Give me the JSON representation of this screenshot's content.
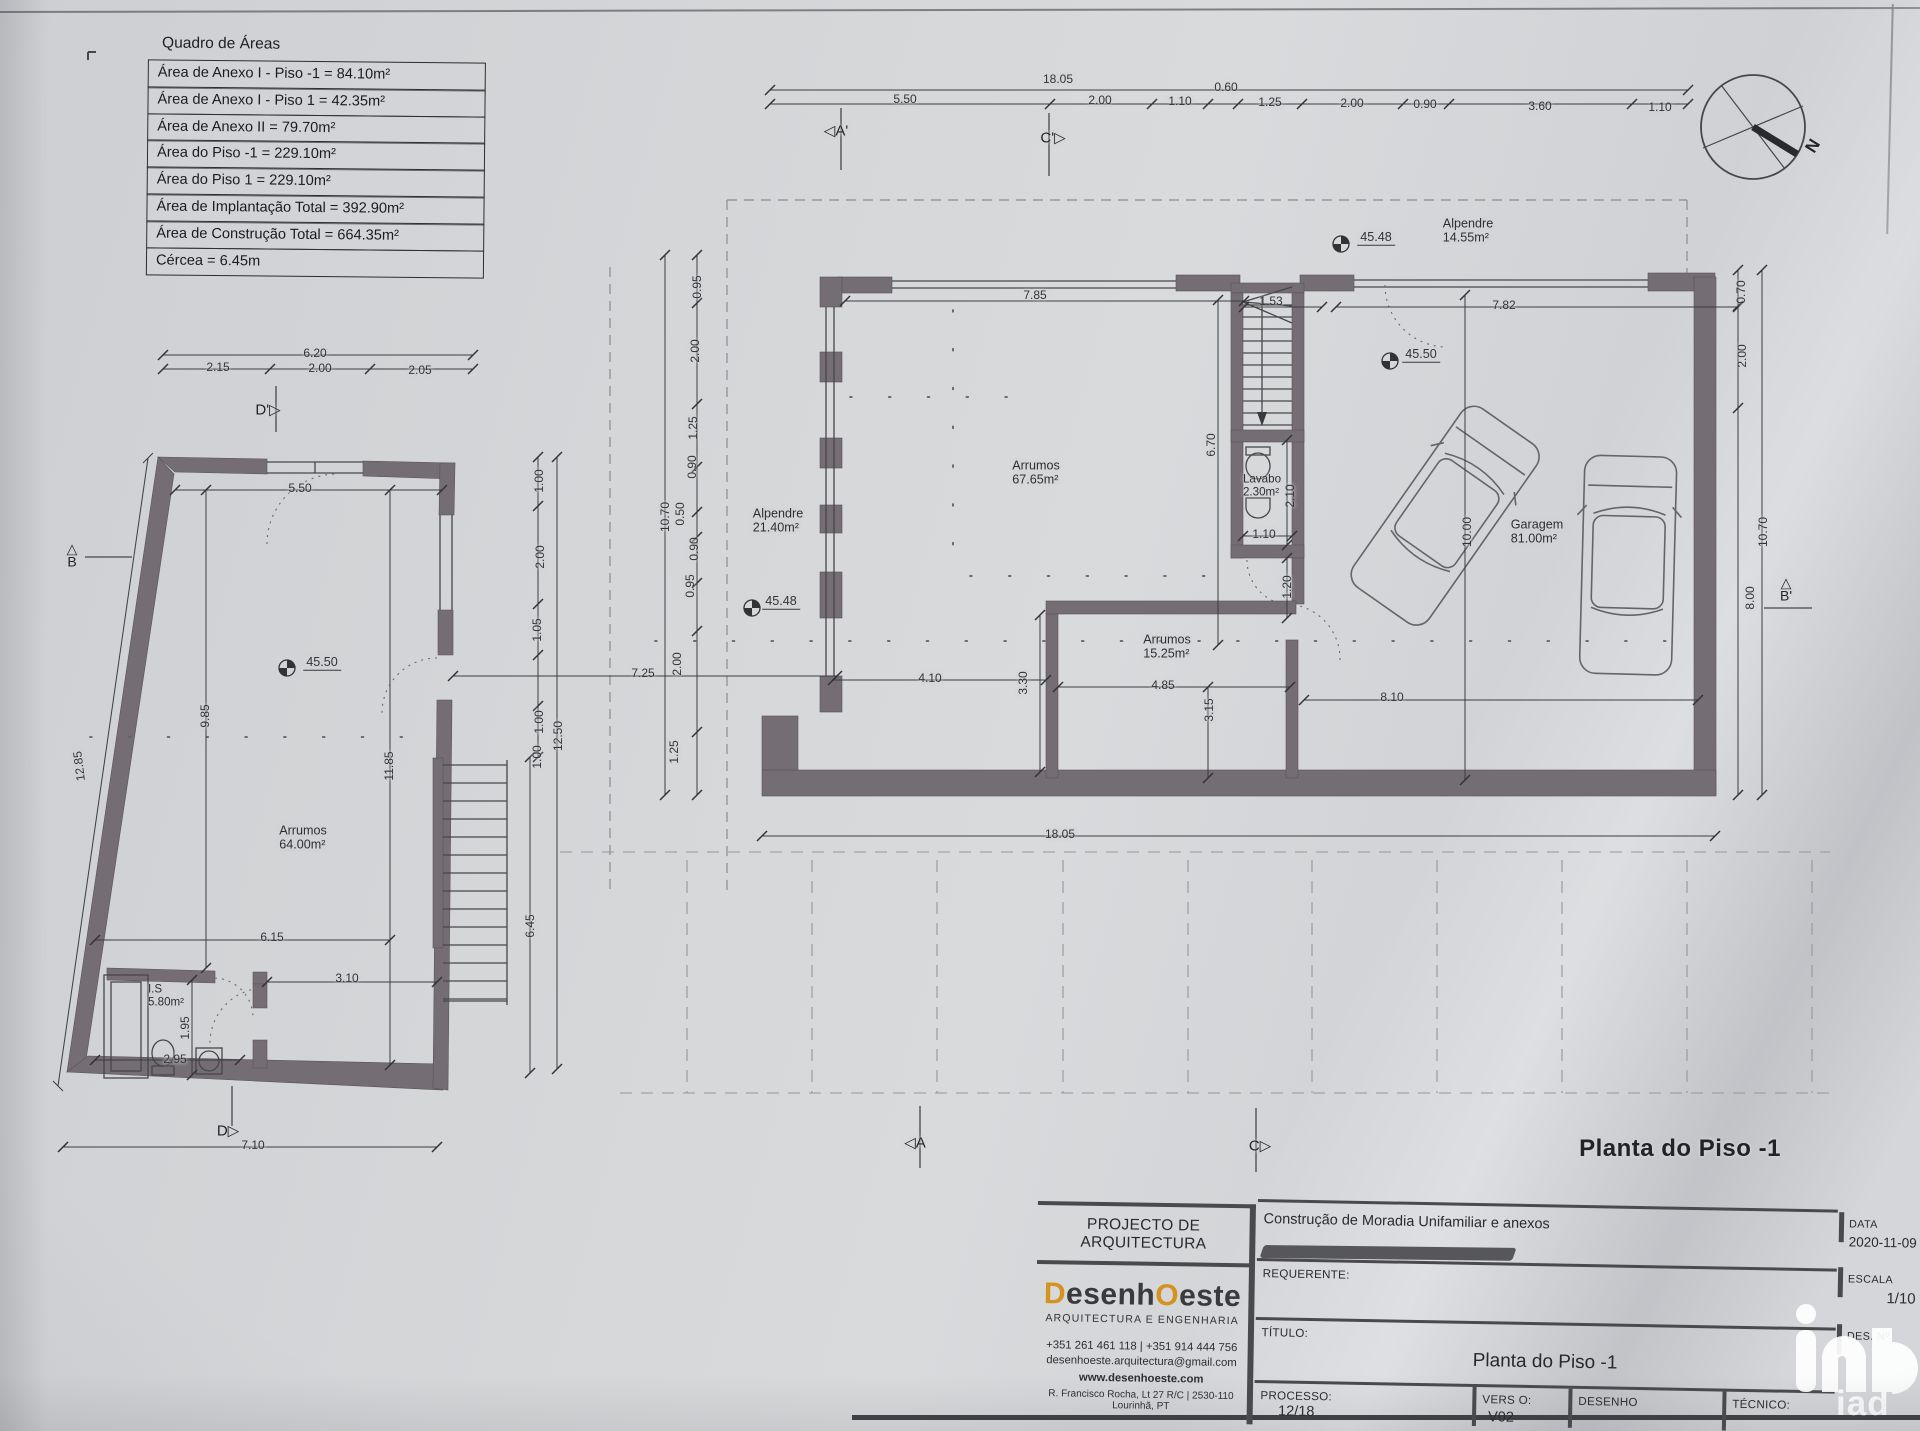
{
  "area_table": {
    "title": "Quadro de Áreas",
    "rows": [
      "Área de Anexo I - Piso -1 = 84.10m²",
      "Área de Anexo I - Piso 1 = 42.35m²",
      "Área de Anexo II = 79.70m²",
      "Área do Piso -1 = 229.10m²",
      "Área do Piso 1 = 229.10m²",
      "Área de Implantação Total = 392.90m²",
      "Área de Construção Total = 664.35m²",
      "Cércea = 6.45m"
    ]
  },
  "title_block": {
    "header": "PROJECTO DE ARQUITECTURA",
    "logo": {
      "d": "D",
      "mid": "esenh",
      "o": "O",
      "end": "este"
    },
    "tagline": "ARQUITECTURA E ENGENHARIA",
    "phone": "+351 261 461 118  |  +351 914 444 756",
    "email": "desenhoeste.arquitectura@gmail.com",
    "website": "www.desenhoeste.com",
    "address": "R. Francisco Rocha, Lt 27 R/C  |  2530-110 Lourinhã, PT",
    "project": "Construção de Moradia Unifamiliar e anexos",
    "requerente_label": "REQUERENTE:",
    "titulo_label": "TÍTULO:",
    "titulo_value": "Planta do Piso -1",
    "processo_label": "PROCESSO:",
    "processo_value": "12/18",
    "versao_label": "VERS O:",
    "versao_value": "V02",
    "desenho_label": "DESENHO",
    "tecnico_label": "TÉCNICO:",
    "data_label": "DATA",
    "data_value": "2020-11-09",
    "escala_label": "ESCALA",
    "escala_value": "1/10",
    "desno_label": "DES. Nº",
    "watermark": "iad"
  },
  "labels": [
    {
      "t": "18.05",
      "x": 1058,
      "y": 80
    },
    {
      "t": "5.50",
      "x": 905,
      "y": 100
    },
    {
      "t": "2.00",
      "x": 1100,
      "y": 101
    },
    {
      "t": "1.10",
      "x": 1180,
      "y": 102
    },
    {
      "t": "0.60",
      "x": 1226,
      "y": 88
    },
    {
      "t": "1.25",
      "x": 1270,
      "y": 103
    },
    {
      "t": "2.00",
      "x": 1352,
      "y": 104
    },
    {
      "t": "0.90",
      "x": 1425,
      "y": 105
    },
    {
      "t": "3.60",
      "x": 1540,
      "y": 107
    },
    {
      "t": "1.10",
      "x": 1660,
      "y": 108
    },
    {
      "t": "◁A'",
      "x": 836,
      "y": 131,
      "c": "mk",
      "n": "section-marker-a-prime"
    },
    {
      "t": "C'▷",
      "x": 1053,
      "y": 138,
      "c": "mk",
      "n": "section-marker-c-prime"
    },
    {
      "t": "6.20",
      "x": 315,
      "y": 354
    },
    {
      "t": "2.15",
      "x": 218,
      "y": 368
    },
    {
      "t": "2.00",
      "x": 320,
      "y": 369
    },
    {
      "t": "2.05",
      "x": 420,
      "y": 371
    },
    {
      "t": "D'▷",
      "x": 268,
      "y": 410,
      "c": "mk",
      "n": "section-marker-d-prime"
    },
    {
      "t": "5.50",
      "x": 300,
      "y": 489
    },
    {
      "t": "45.50",
      "x": 322,
      "y": 663,
      "c": "lv",
      "n": "level-45-50-annex"
    },
    {
      "t": "Arrumos\n64.00m²",
      "x": 303,
      "y": 838,
      "c": "rm",
      "n": "room-label-arrumos-annex"
    },
    {
      "t": "9.85",
      "x": 206,
      "y": 716,
      "r": -90
    },
    {
      "t": "12.85",
      "x": 80,
      "y": 766,
      "r": -97
    },
    {
      "t": "11.85",
      "x": 390,
      "y": 766,
      "r": -90
    },
    {
      "t": "6.15",
      "x": 272,
      "y": 938
    },
    {
      "t": "3.10",
      "x": 347,
      "y": 979
    },
    {
      "t": "I.S\n5.80m²",
      "x": 166,
      "y": 996,
      "c": "rm sm",
      "n": "room-label-is"
    },
    {
      "t": "1.95",
      "x": 186,
      "y": 1028,
      "r": -90
    },
    {
      "t": "2.95",
      "x": 175,
      "y": 1060
    },
    {
      "t": "△\nB",
      "x": 72,
      "y": 556,
      "c": "mk pre",
      "n": "section-marker-b"
    },
    {
      "t": "D▷",
      "x": 228,
      "y": 1131,
      "c": "mk",
      "n": "section-marker-d"
    },
    {
      "t": "7.10",
      "x": 253,
      "y": 1146
    },
    {
      "t": "1.00",
      "x": 540,
      "y": 481,
      "r": -90
    },
    {
      "t": "2.00",
      "x": 541,
      "y": 557,
      "r": -90
    },
    {
      "t": "1.05",
      "x": 538,
      "y": 630,
      "r": -90
    },
    {
      "t": "1.00",
      "x": 540,
      "y": 722,
      "r": -90
    },
    {
      "t": "1.00",
      "x": 538,
      "y": 757,
      "r": -90
    },
    {
      "t": "12.50",
      "x": 559,
      "y": 736,
      "r": -90
    },
    {
      "t": "6.45",
      "x": 531,
      "y": 926,
      "r": -90
    },
    {
      "t": "7.25",
      "x": 643,
      "y": 674
    },
    {
      "t": "10.70",
      "x": 666,
      "y": 517,
      "r": -90
    },
    {
      "t": "0.95",
      "x": 698,
      "y": 287,
      "r": -90
    },
    {
      "t": "2.00",
      "x": 696,
      "y": 351,
      "r": -90
    },
    {
      "t": "1.25",
      "x": 694,
      "y": 428,
      "r": -90
    },
    {
      "t": "0.90",
      "x": 693,
      "y": 467,
      "r": -90
    },
    {
      "t": "0.50",
      "x": 681,
      "y": 514,
      "r": -90
    },
    {
      "t": "0.90",
      "x": 695,
      "y": 549,
      "r": -90
    },
    {
      "t": "0.95",
      "x": 691,
      "y": 586,
      "r": -90
    },
    {
      "t": "2.00",
      "x": 678,
      "y": 664,
      "r": -90
    },
    {
      "t": "1.25",
      "x": 675,
      "y": 752,
      "r": -90
    },
    {
      "t": "7.85",
      "x": 1035,
      "y": 296
    },
    {
      "t": "1.53",
      "x": 1271,
      "y": 302
    },
    {
      "t": "7.82",
      "x": 1504,
      "y": 306
    },
    {
      "t": "45.48",
      "x": 1376,
      "y": 238,
      "c": "lv",
      "n": "level-45-48-top"
    },
    {
      "t": "45.50",
      "x": 1421,
      "y": 355,
      "c": "lv",
      "n": "level-45-50-garage"
    },
    {
      "t": "45.48",
      "x": 781,
      "y": 602,
      "c": "lv",
      "n": "level-45-48-alpendre"
    },
    {
      "t": "Alpendre\n21.40m²",
      "x": 778,
      "y": 521,
      "c": "rm",
      "n": "room-label-alpendre-left"
    },
    {
      "t": "Arrumos\n67.65m²",
      "x": 1036,
      "y": 473,
      "c": "rm",
      "n": "room-label-arrumos-main"
    },
    {
      "t": "Lavabo\n2.30m²",
      "x": 1262,
      "y": 486,
      "c": "rm sm",
      "n": "room-label-lavabo"
    },
    {
      "t": "2.10",
      "x": 1291,
      "y": 496,
      "r": -90
    },
    {
      "t": "1.10",
      "x": 1264,
      "y": 535
    },
    {
      "t": "6.70",
      "x": 1212,
      "y": 445,
      "r": -90
    },
    {
      "t": "1.20",
      "x": 1288,
      "y": 587,
      "r": -90
    },
    {
      "t": "Arrumos\n15.25m²",
      "x": 1167,
      "y": 647,
      "c": "rm",
      "n": "room-label-arrumos-15"
    },
    {
      "t": "4.10",
      "x": 930,
      "y": 679
    },
    {
      "t": "3.30",
      "x": 1024,
      "y": 683,
      "r": -90
    },
    {
      "t": "4.85",
      "x": 1163,
      "y": 686
    },
    {
      "t": "3.15",
      "x": 1210,
      "y": 710,
      "r": -90
    },
    {
      "t": "10.00",
      "x": 1468,
      "y": 532,
      "r": -90
    },
    {
      "t": "Garagem\n81.00m²",
      "x": 1537,
      "y": 532,
      "c": "rm",
      "n": "room-label-garagem"
    },
    {
      "t": "Alpendre\n14.55m²",
      "x": 1468,
      "y": 231,
      "c": "rm",
      "n": "room-label-alpendre-top"
    },
    {
      "t": "8.10",
      "x": 1392,
      "y": 698
    },
    {
      "t": "18.05",
      "x": 1060,
      "y": 835
    },
    {
      "t": "0.70",
      "x": 1742,
      "y": 292,
      "r": -90
    },
    {
      "t": "2.00",
      "x": 1743,
      "y": 356,
      "r": -90
    },
    {
      "t": "10.70",
      "x": 1764,
      "y": 532,
      "r": -90
    },
    {
      "t": "8.00",
      "x": 1751,
      "y": 598,
      "r": -90
    },
    {
      "t": "△\nB'",
      "x": 1786,
      "y": 590,
      "c": "mk pre",
      "n": "section-marker-b-prime"
    },
    {
      "t": "◁A",
      "x": 915,
      "y": 1143,
      "c": "mk",
      "n": "section-marker-a"
    },
    {
      "t": "C▷",
      "x": 1260,
      "y": 1146,
      "c": "mk",
      "n": "section-marker-c"
    },
    {
      "t": "Planta do Piso -1",
      "x": 1680,
      "y": 1149,
      "c": "big",
      "n": "plan-title-label"
    },
    {
      "t": "N",
      "x": 1813,
      "y": 146,
      "r": -58,
      "c": "mk nb",
      "n": "compass-n-label"
    }
  ]
}
